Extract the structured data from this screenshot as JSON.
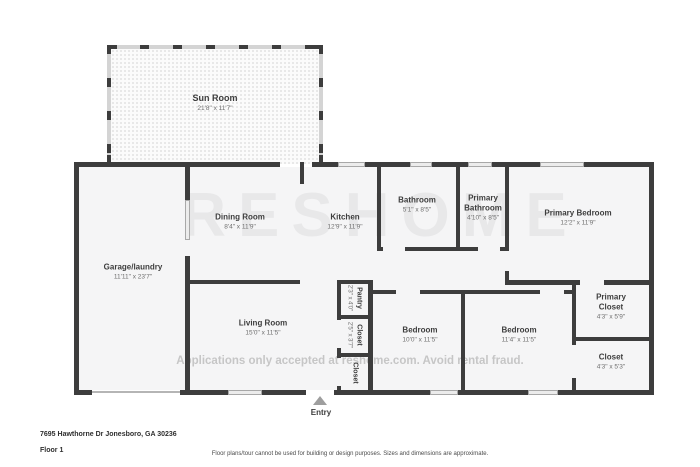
{
  "floorplan": {
    "watermark": {
      "brand": "RESHOME",
      "notice": "Applications only accepted at reshome.com. Avoid rental fraud."
    },
    "rooms": [
      {
        "name": "Sun Room",
        "dims": "21'8\" x 11'7\""
      },
      {
        "name": "Garage/laundry",
        "dims": "11'11\" x 23'7\""
      },
      {
        "name": "Dining Room",
        "dims": "8'4\" x 11'9\""
      },
      {
        "name": "Kitchen",
        "dims": "12'9\" x 11'9\""
      },
      {
        "name": "Bathroom",
        "dims": "5'1\" x 8'5\""
      },
      {
        "name": "Primary Bathroom",
        "dims": "4'10\" x 8'5\""
      },
      {
        "name": "Primary Bedroom",
        "dims": "12'2\" x 11'9\""
      },
      {
        "name": "Living Room",
        "dims": "15'0\" x 11'5\""
      },
      {
        "name": "Pantry",
        "dims": "2'3\" x 4'0\""
      },
      {
        "name": "Closet",
        "dims": "2'5\" x 3'7\""
      },
      {
        "name": "Closet",
        "dims": ""
      },
      {
        "name": "Bedroom",
        "dims": "10'0\" x 11'5\""
      },
      {
        "name": "Bedroom",
        "dims": "11'4\" x 11'5\""
      },
      {
        "name": "Primary Closet",
        "dims": "4'3\" x 5'9\""
      },
      {
        "name": "Closet",
        "dims": "4'3\" x 5'3\""
      }
    ],
    "entry_label": "Entry",
    "footer": {
      "address": "7695 Hawthorne Dr Jonesboro, GA 30236",
      "floor": "Floor 1",
      "disclaimer": "Floor plans/tour cannot be used for building or design purposes. Sizes and dimensions are approximate."
    },
    "colors": {
      "wall": "#3d3d3d",
      "room_fill": "#f5f5f6",
      "window": "#ececec",
      "entry_arrow": "#9e9e9e"
    }
  }
}
